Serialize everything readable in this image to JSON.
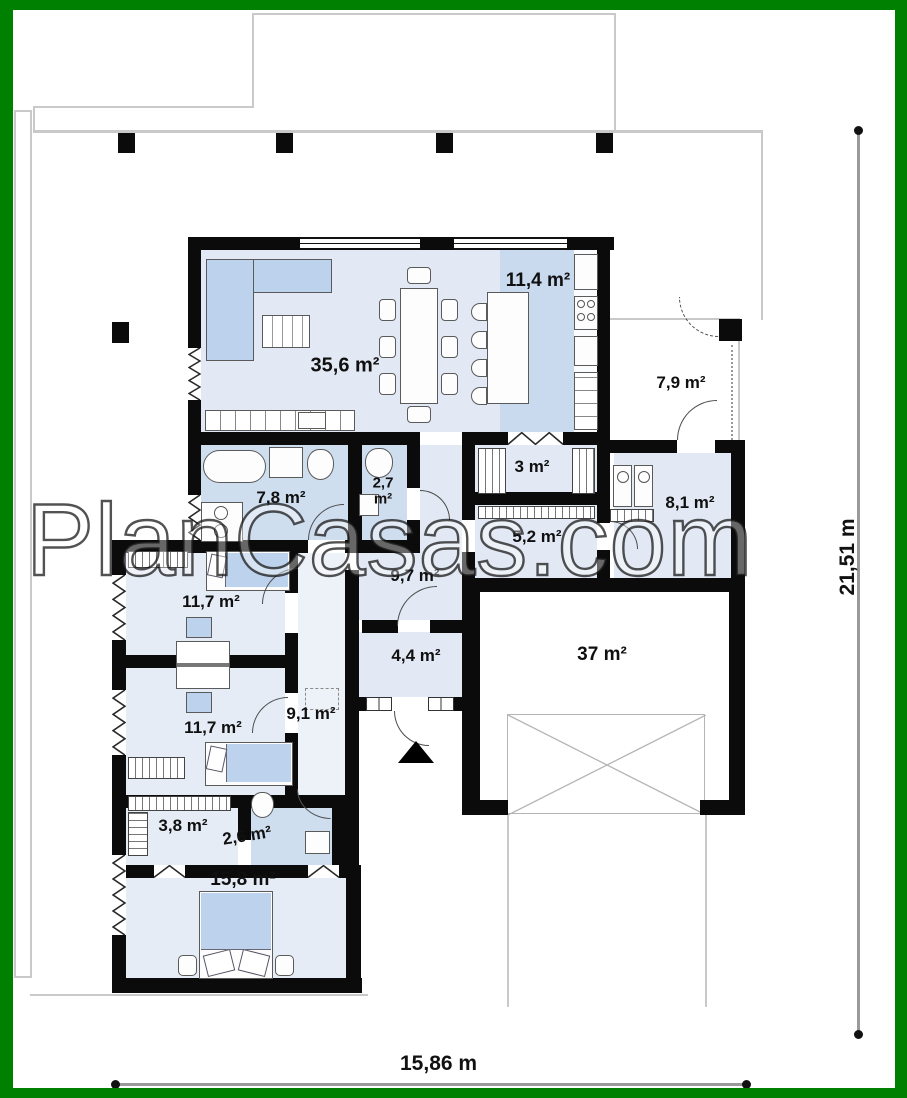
{
  "frame": {
    "border_color": "#008000",
    "background": "#ffffff"
  },
  "watermark": {
    "text": "PlanCasas.com"
  },
  "dimensions": {
    "bottom_label": "15,86 m",
    "right_label": "21,51 m"
  },
  "rooms": {
    "living": "35,6 m²",
    "kitchen": "11,4 m²",
    "porch": "7,9 m²",
    "pantry": "3 m²",
    "utility": "8,1 m²",
    "hall_small": "5,2 m²",
    "bathroom": "7,8 m²",
    "wc": "2,7 m²",
    "corridor": "9,7 m²",
    "bedroom1": "11,7 m²",
    "vestibule": "4,4 m²",
    "garage": "37 m²",
    "hall": "9,1 m²",
    "bedroom2": "11,7 m²",
    "closet": "3,8 m²",
    "bathroom2": "2,6 m²",
    "master_bedroom": "15,8 m²"
  }
}
